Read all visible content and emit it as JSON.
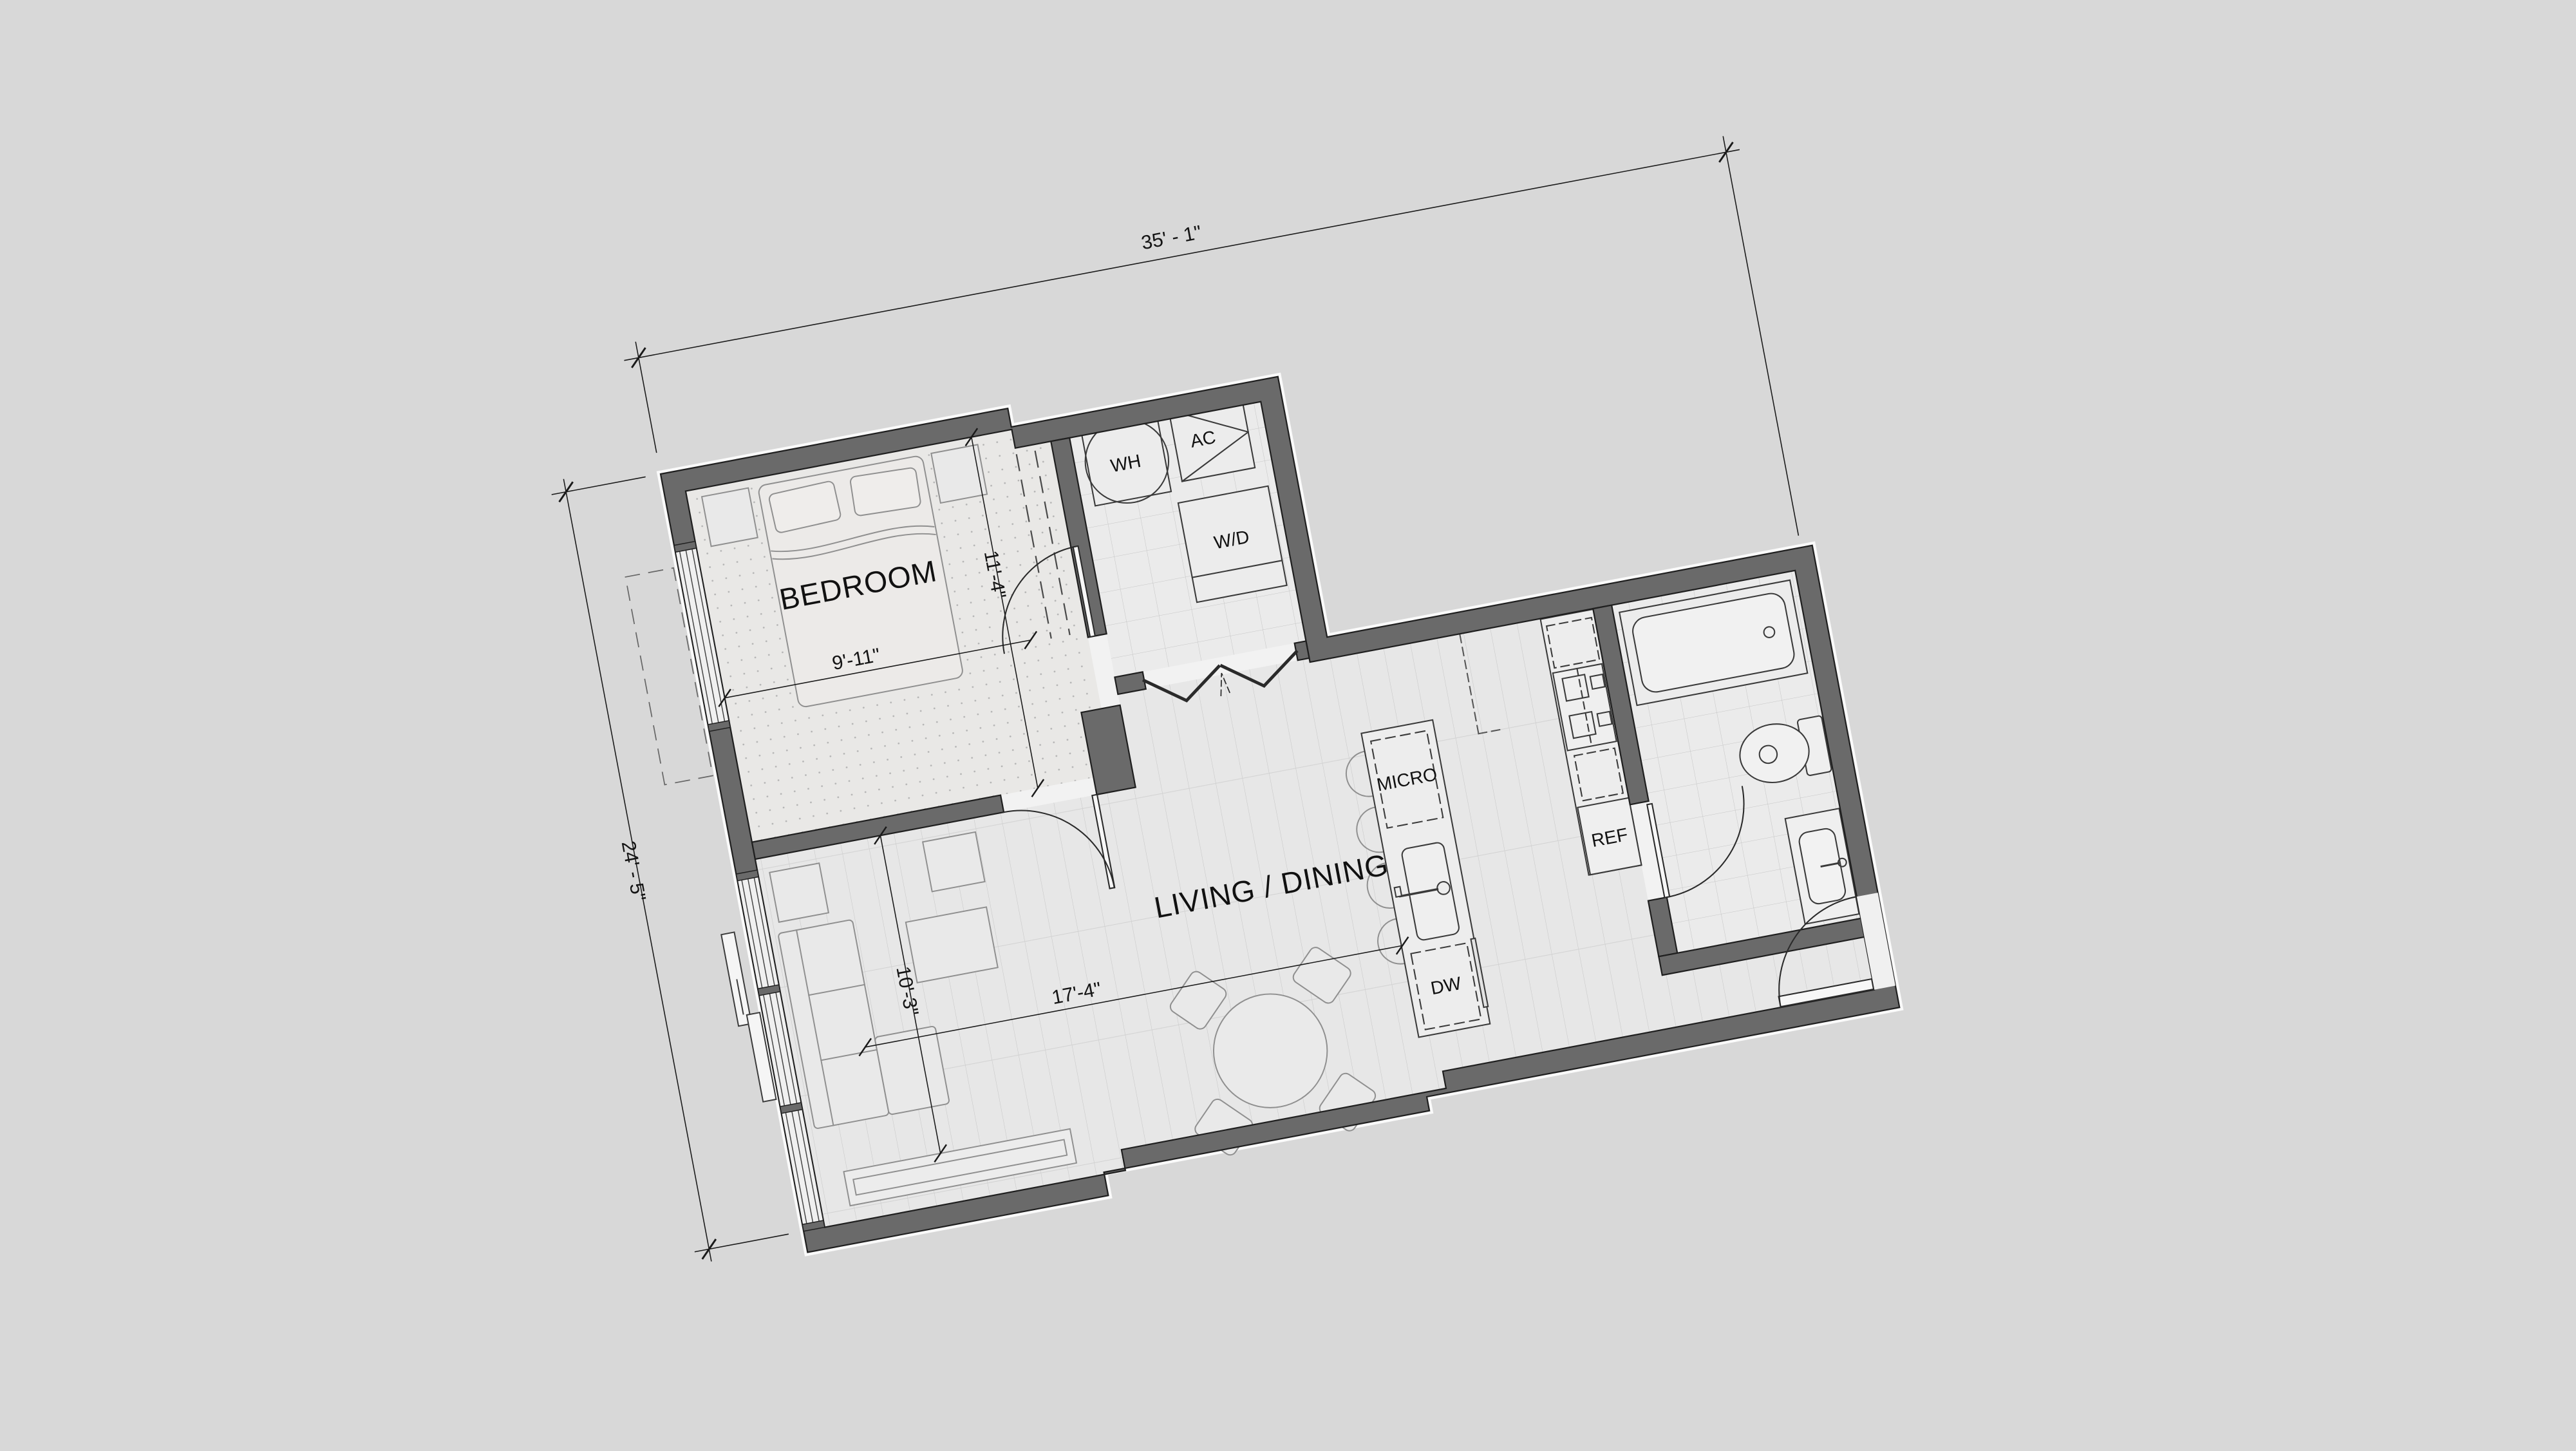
{
  "drawing": {
    "type": "apartment-floor-plan",
    "rotation_degrees": -10.7,
    "rooms": [
      "BEDROOM",
      "LIVING / DINING",
      "BATHROOM",
      "UTILITY CLOSET",
      "ENTRY"
    ],
    "labels": {
      "bedroom": "BEDROOM",
      "living": "LIVING / DINING",
      "wh": "WH",
      "ac": "AC",
      "wd": "W/D",
      "micro": "MICRO",
      "dw": "DW",
      "ref": "REF"
    },
    "dimensions": {
      "overall_width": "35' - 1\"",
      "overall_height": "24' - 5\"",
      "bedroom_width": "9'-11\"",
      "bedroom_height": "11'-4\"",
      "living_height": "10'-3\"",
      "living_width": "17'-4\""
    },
    "fixtures": [
      "bed",
      "pillow",
      "nightstand",
      "closet-rod",
      "water-heater",
      "ac-unit",
      "washer-dryer",
      "bifold-doors",
      "kitchen-island",
      "island-sink",
      "island-faucet",
      "bar-stool",
      "microwave-location",
      "dishwasher-location",
      "cooktop",
      "oven-location",
      "refrigerator",
      "bathtub",
      "toilet",
      "vanity-sink",
      "sofa",
      "chaise",
      "coffee-table",
      "end-table",
      "side-table",
      "tv-console",
      "dining-table",
      "dining-chair",
      "entry-door",
      "bathroom-door",
      "bedroom-door",
      "closet-door",
      "window-wall",
      "sliding-door"
    ],
    "colors": {
      "background": "#d8d8d8",
      "wall_fill": "#6a6a6a",
      "wall_outline": "#1f1f1f",
      "floor_plank": "#e7e7e7",
      "floor_carpet": "#e9e8e6",
      "floor_tile": "#ebebeb",
      "fixture_line": "#3a3a3a",
      "dimension_line": "#1a1a1a"
    }
  }
}
